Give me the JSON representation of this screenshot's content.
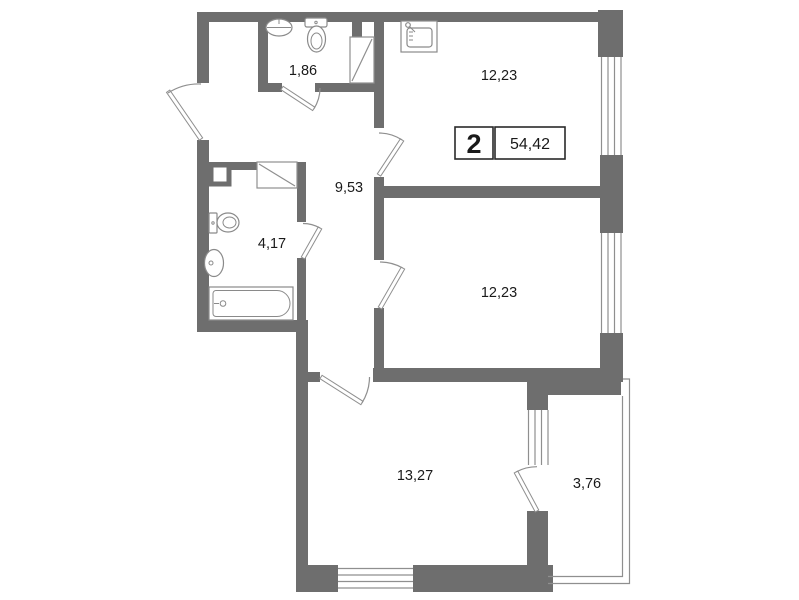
{
  "plan_title": "apartment-floor-plan",
  "colors": {
    "wall": "#6e6e6e",
    "thin_line": "#8f8f8f",
    "fixture_line": "#8a8a8a",
    "box_border": "#2a2a2a",
    "text": "#1a1a1a",
    "background": "#ffffff"
  },
  "summary_box": {
    "rooms_count": "2",
    "total_area": "54,42"
  },
  "rooms": [
    {
      "id": "wc",
      "area_label": "1,86"
    },
    {
      "id": "kitchen",
      "area_label": "12,23"
    },
    {
      "id": "hallway",
      "area_label": "9,53"
    },
    {
      "id": "bathroom",
      "area_label": "4,17"
    },
    {
      "id": "bedroom",
      "area_label": "12,23"
    },
    {
      "id": "living-room",
      "area_label": "13,27"
    },
    {
      "id": "balcony",
      "area_label": "3,76"
    }
  ]
}
